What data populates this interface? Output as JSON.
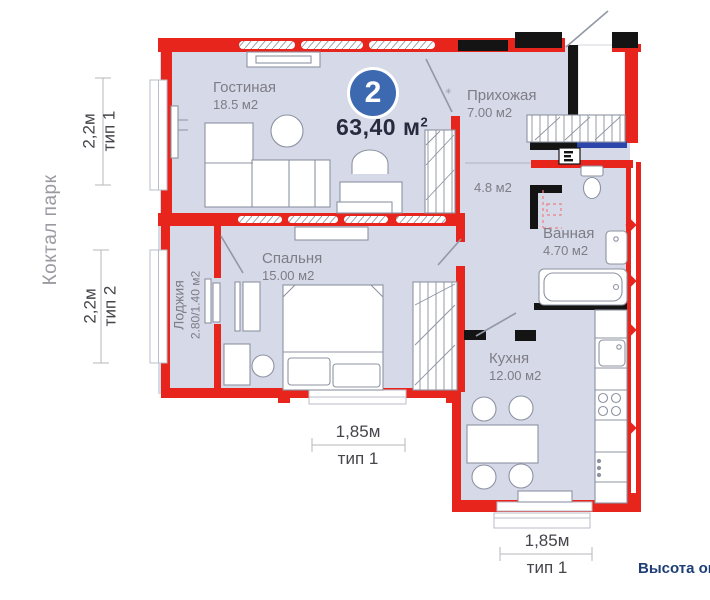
{
  "side_label": "Коктал парк",
  "bottom_note": "Высота ок",
  "entry_star": "✳",
  "badge": {
    "rooms_count": "2",
    "total_area": "63,40 м",
    "total_area_sup": "2"
  },
  "rooms": {
    "living": {
      "name": "Гостиная",
      "area": "18.5 м2"
    },
    "hallway": {
      "name": "Прихожая",
      "area": "7.00 м2"
    },
    "corridor": {
      "area": "4.8 м2"
    },
    "bathroom": {
      "name": "Ванная",
      "area": "4.70 м2"
    },
    "bedroom": {
      "name": "Спальня",
      "area": "15.00 м2"
    },
    "loggia": {
      "name": "Лоджия",
      "area": "2.80/1.40 м2"
    },
    "kitchen": {
      "name": "Кухня",
      "area": "12.00 м2"
    }
  },
  "dimensions": {
    "left_top": {
      "value": "2,2м",
      "type": "тип 1"
    },
    "left_bottom": {
      "value": "2,2м",
      "type": "тип 2"
    },
    "bottom_bedroom": {
      "value": "1,85м",
      "type": "тип 1"
    },
    "bottom_kitchen": {
      "value": "1,85м",
      "type": "тип 1"
    }
  },
  "colors": {
    "wall_red": "#e8251d",
    "wall_black": "#141414",
    "floor": "#d6d9e8",
    "badge_blue": "#3d69b1",
    "entry_door_blue": "#2c45ab",
    "note_navy": "#1d3e75",
    "label_gray": "#7d7d85"
  }
}
